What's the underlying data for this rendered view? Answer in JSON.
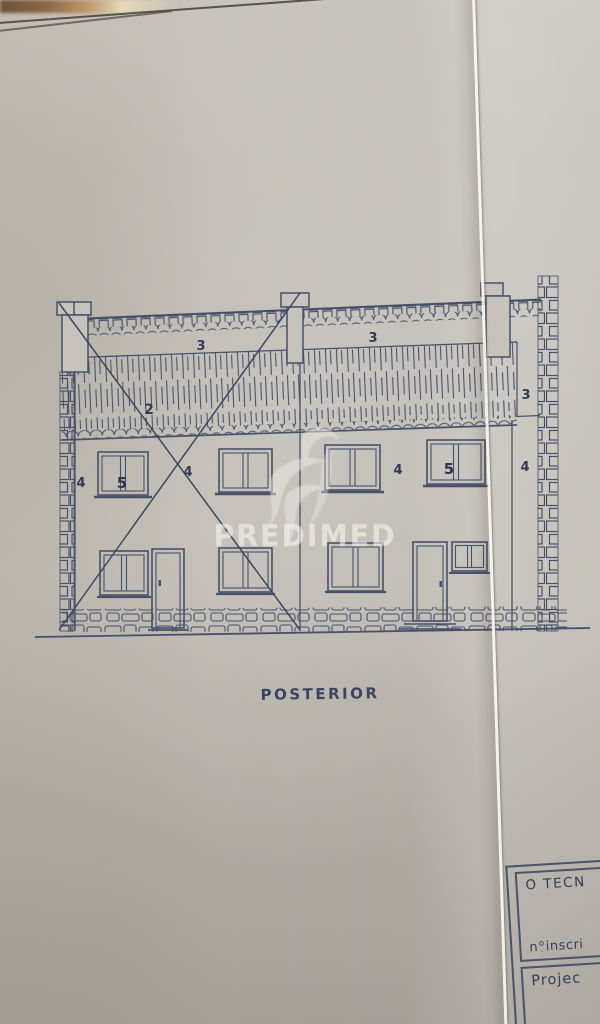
{
  "document_kind": "scanned architectural elevation drawing",
  "drawing": {
    "caption": "POSTERIOR",
    "labels": {
      "roof_left": "3",
      "roof_right": "3",
      "roof_end": "3",
      "tile_band": "2",
      "wall_left_a": "4",
      "window_left": "5",
      "wall_left_b": "4",
      "wall_right_a": "4",
      "window_right": "5",
      "wall_right_b": "4"
    },
    "ink_color": "#47516a",
    "paper_color": "#c2beb6"
  },
  "watermark": {
    "text": "PREDIMED",
    "bird_icon": "bird-swoosh-watermark"
  },
  "title_block": {
    "line1": "O TECN",
    "line2_n": "n",
    "line2_ord": "o",
    "line2_dot": ".",
    "line2_rest": "inscri",
    "line3": "Projec"
  }
}
